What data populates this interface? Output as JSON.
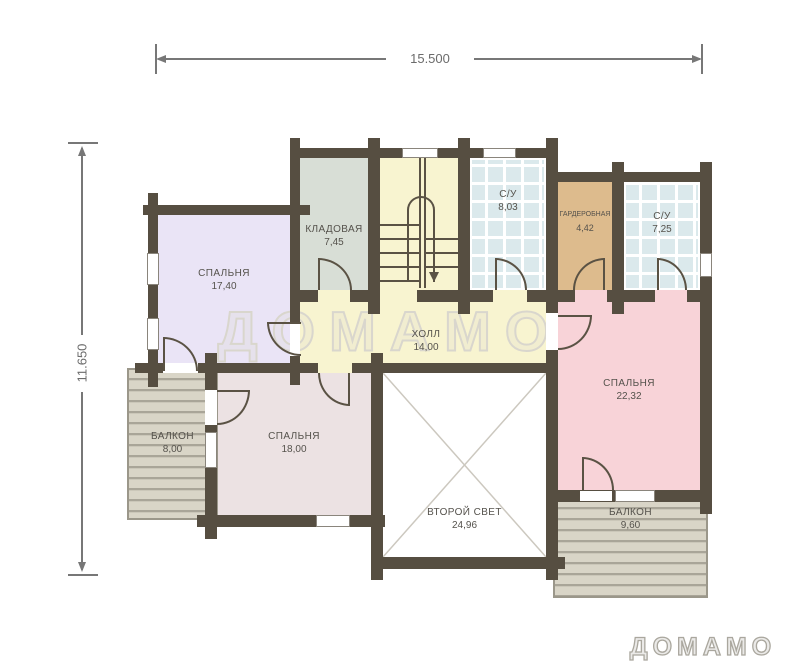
{
  "dimensions": {
    "width": "15.500",
    "height": "11.650"
  },
  "watermark": "ДОМАМО",
  "logo": "ДОМАМО",
  "rooms": {
    "bedroom1": {
      "name": "СПАЛЬНЯ",
      "area": "17,40"
    },
    "storage": {
      "name": "КЛАДОВАЯ",
      "area": "7,45"
    },
    "bath1": {
      "name": "С/У",
      "area": "8,03"
    },
    "wardrobe": {
      "name": "ГАРДЕРОБНАЯ",
      "area": "4,42"
    },
    "bath2": {
      "name": "С/У",
      "area": "7,25"
    },
    "hall": {
      "name": "ХОЛЛ",
      "area": "14,00"
    },
    "bedroom2": {
      "name": "СПАЛЬНЯ",
      "area": "22,32"
    },
    "bedroom3": {
      "name": "СПАЛЬНЯ",
      "area": "18,00"
    },
    "balcony1": {
      "name": "БАЛКОН",
      "area": "8,00"
    },
    "void": {
      "name": "ВТОРОЙ СВЕТ",
      "area": "24,96"
    },
    "balcony2": {
      "name": "БАЛКОН",
      "area": "9,60"
    }
  },
  "colors": {
    "wall": "#564e41",
    "line": "#5a5244",
    "bedroom1": "#eae4f6",
    "storage": "#d8ded6",
    "bath": "#dbe9ec",
    "wardrobe": "#ddbb8d",
    "hall": "#f8f4d0",
    "bedroom2": "#f8d3d8",
    "bedroom3": "#ece2e3",
    "void": "#ffffff"
  }
}
